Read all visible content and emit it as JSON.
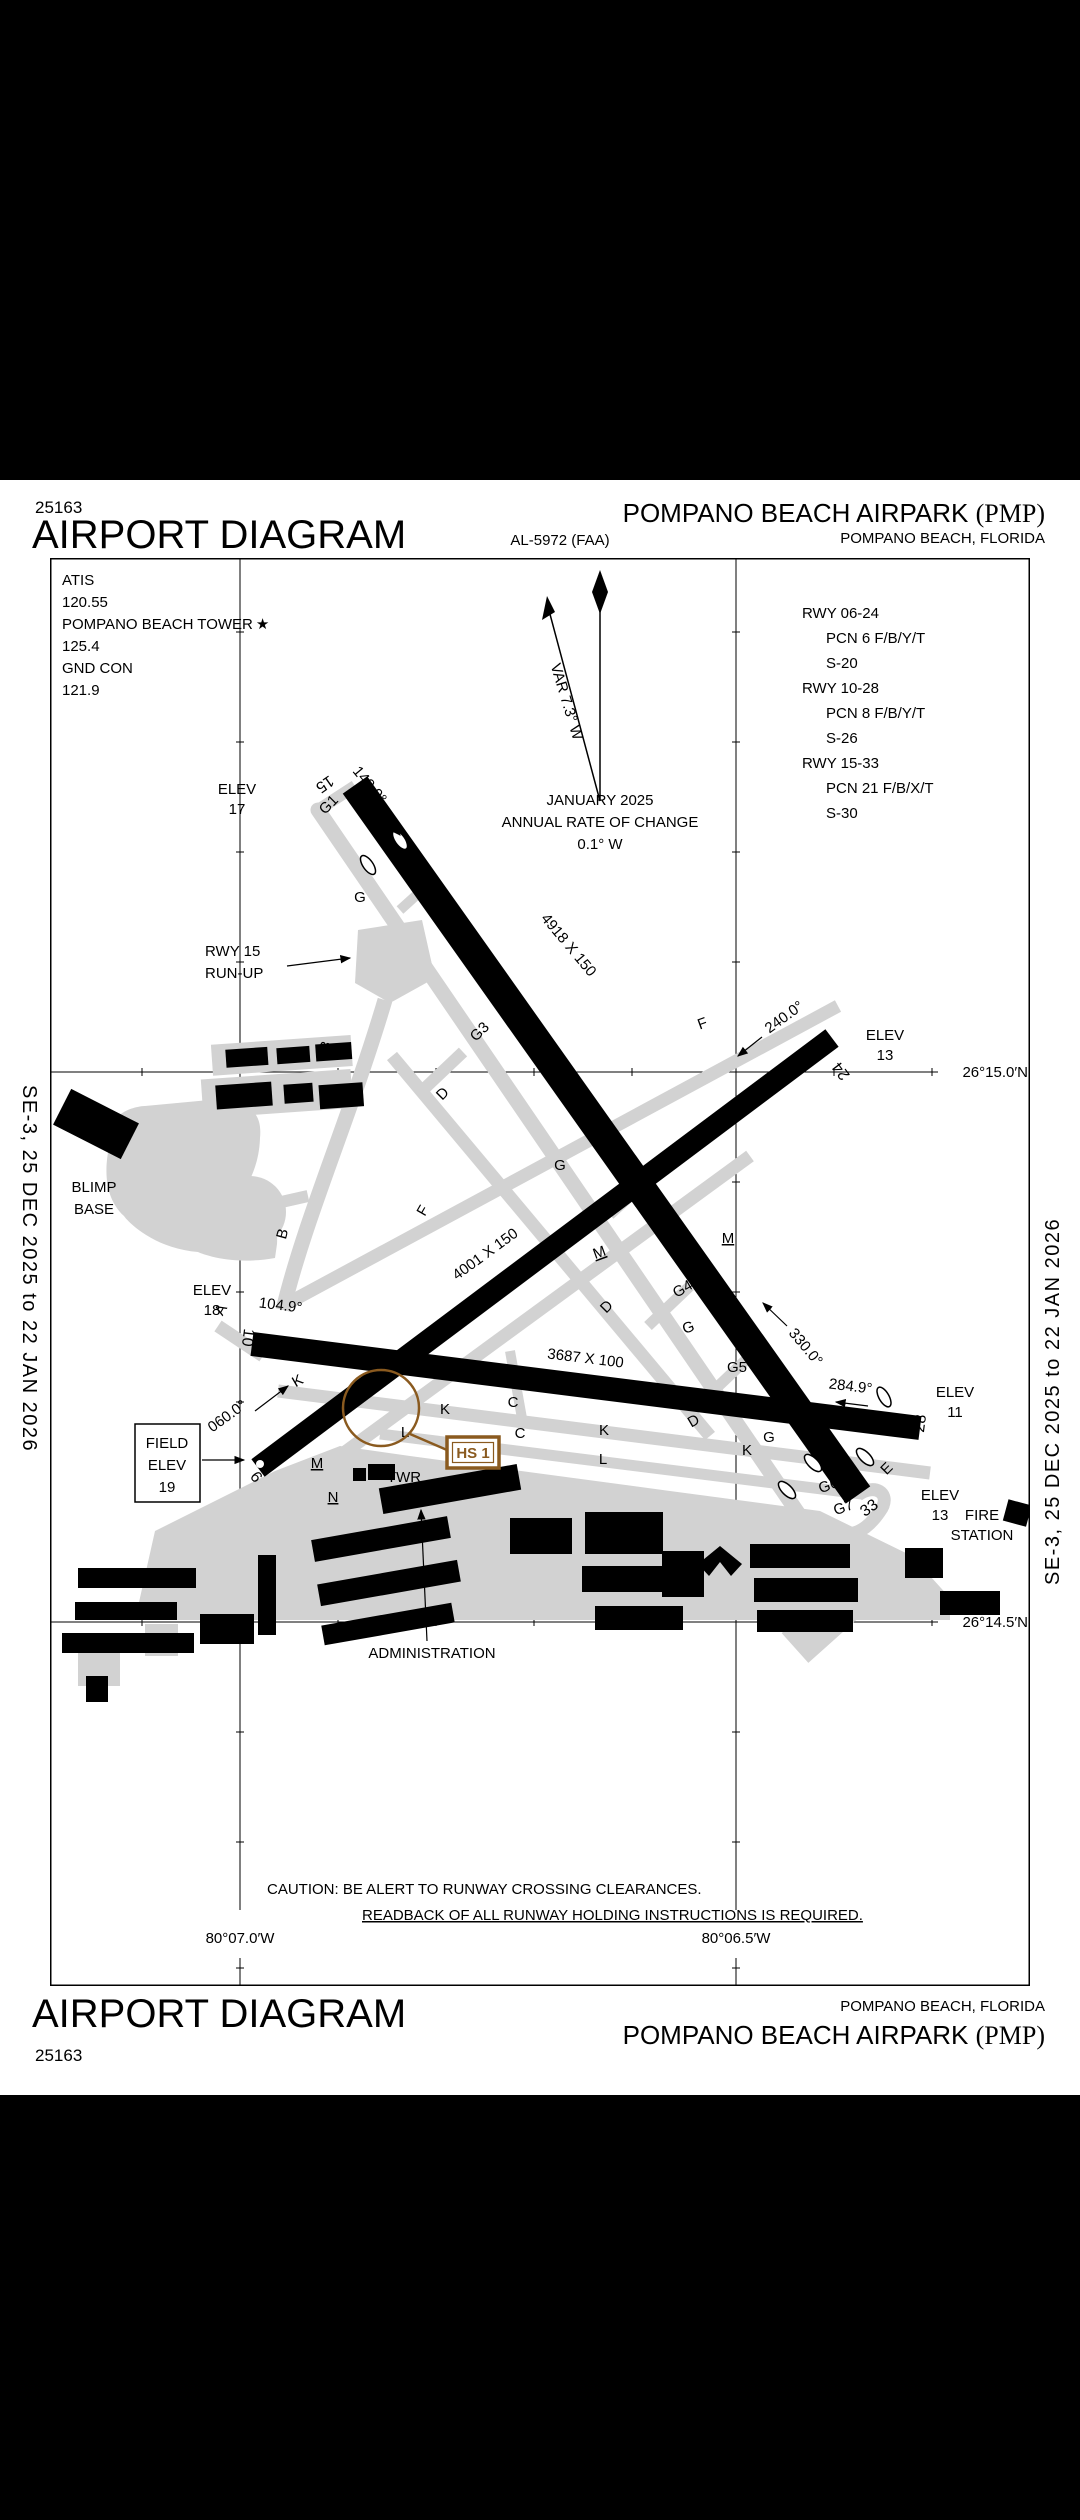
{
  "page": {
    "chart_number": "25163",
    "title": "AIRPORT DIAGRAM",
    "procedure_id": "AL-5972 (FAA)",
    "airport_name": "POMPANO BEACH AIRPARK",
    "airport_ident": "(PMP)",
    "city": "POMPANO BEACH, FLORIDA",
    "edition": "SE-3,  25 DEC 2025  to  22 JAN 2026"
  },
  "comms": {
    "atis_label": "ATIS",
    "atis_freq": "120.55",
    "twr_label": "POMPANO BEACH TOWER",
    "twr_star": "★",
    "twr_freq": "125.4",
    "gnd_label": "GND CON",
    "gnd_freq": "121.9"
  },
  "runway_data": [
    {
      "rwy": "RWY 06-24",
      "pcn": "PCN 6 F/B/Y/T",
      "s": "S-20"
    },
    {
      "rwy": "RWY 10-28",
      "pcn": "PCN 8 F/B/Y/T",
      "s": "S-26"
    },
    {
      "rwy": "RWY 15-33",
      "pcn": "PCN 21 F/B/X/T",
      "s": "S-30"
    }
  ],
  "variation": {
    "var": "VAR 7.3° W",
    "date": "JANUARY 2025",
    "rate_label": "ANNUAL RATE OF CHANGE",
    "rate": "0.1° W"
  },
  "graticule": {
    "lat_top": "26°15.0′N",
    "lat_bottom": "26°14.5′N",
    "lon_left": "80°07.0′W",
    "lon_right": "80°06.5′W"
  },
  "caution": {
    "line1": "CAUTION: BE ALERT TO RUNWAY CROSSING CLEARANCES.",
    "line2": "READBACK OF ALL RUNWAY HOLDING INSTRUCTIONS IS REQUIRED."
  },
  "runways": {
    "r15": "15",
    "r33": "33",
    "r10": "10",
    "r28": "28",
    "r06": "6",
    "r24": "24",
    "dim_15_33": "4918 X 150",
    "dim_06_24": "4001 X 150",
    "dim_10_28": "3687 X 100",
    "hdg_15": "149.9°",
    "hdg_33": "330.0°",
    "hdg_10": "104.9°",
    "hdg_28": "284.9°",
    "hdg_06": "060.0°",
    "hdg_24": "240.0°"
  },
  "elevations": {
    "elev_label": "ELEV",
    "e15": "17",
    "e24": "13",
    "e10": "18",
    "e28": "11",
    "e33": "13",
    "field1": "FIELD",
    "field2": "ELEV",
    "field3": "19"
  },
  "facilities": {
    "blimp1": "BLIMP",
    "blimp2": "BASE",
    "runup1": "RWY 15",
    "runup2": "RUN-UP",
    "twr": "TWR",
    "admin": "ADMINISTRATION",
    "beacon_star": "☆",
    "fire1": "FIRE",
    "fire2": "STATION",
    "hotspot": "HS 1"
  },
  "taxiways": {
    "a": "A",
    "b": "B",
    "c": "C",
    "d": "D",
    "e": "E",
    "f": "F",
    "g": "G",
    "g1": "G1",
    "g3": "G3",
    "g4": "G4",
    "g5": "G5",
    "g6": "G6",
    "g7": "G7",
    "k": "K",
    "l": "L",
    "m": "M",
    "n": "N"
  },
  "colors": {
    "hotspot_brown": "#8a5a1f",
    "taxiway_gray": "#d2d2d2"
  }
}
